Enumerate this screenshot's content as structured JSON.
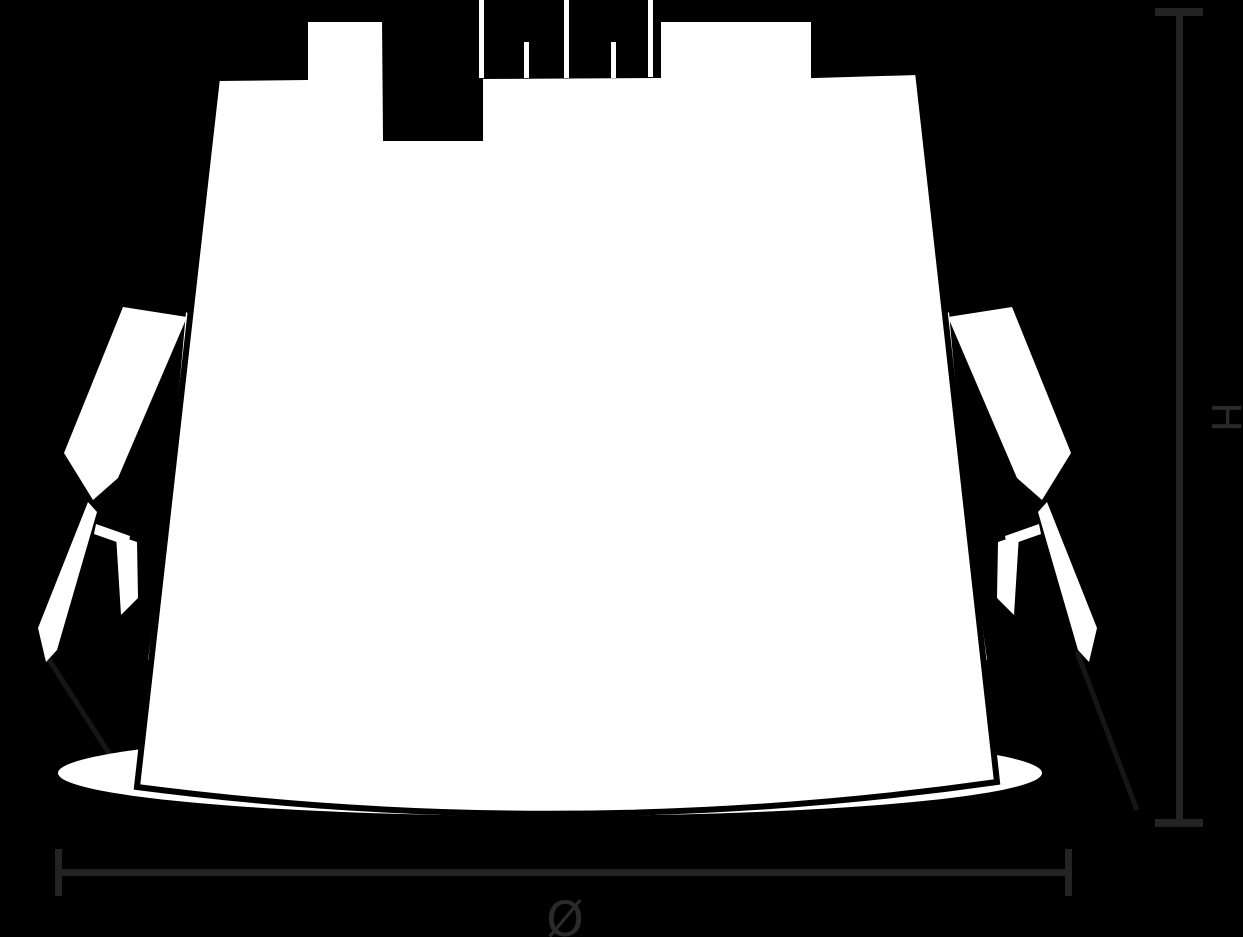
{
  "page": {
    "background": "#000000"
  },
  "fixture": {
    "color": "#ffffff",
    "outline": "#000000",
    "wire_color": "#161616"
  },
  "dimensions": {
    "line_color": "#232323",
    "text_color": "#2a2a2a",
    "height_label": "H",
    "diameter_label": "Ø"
  }
}
